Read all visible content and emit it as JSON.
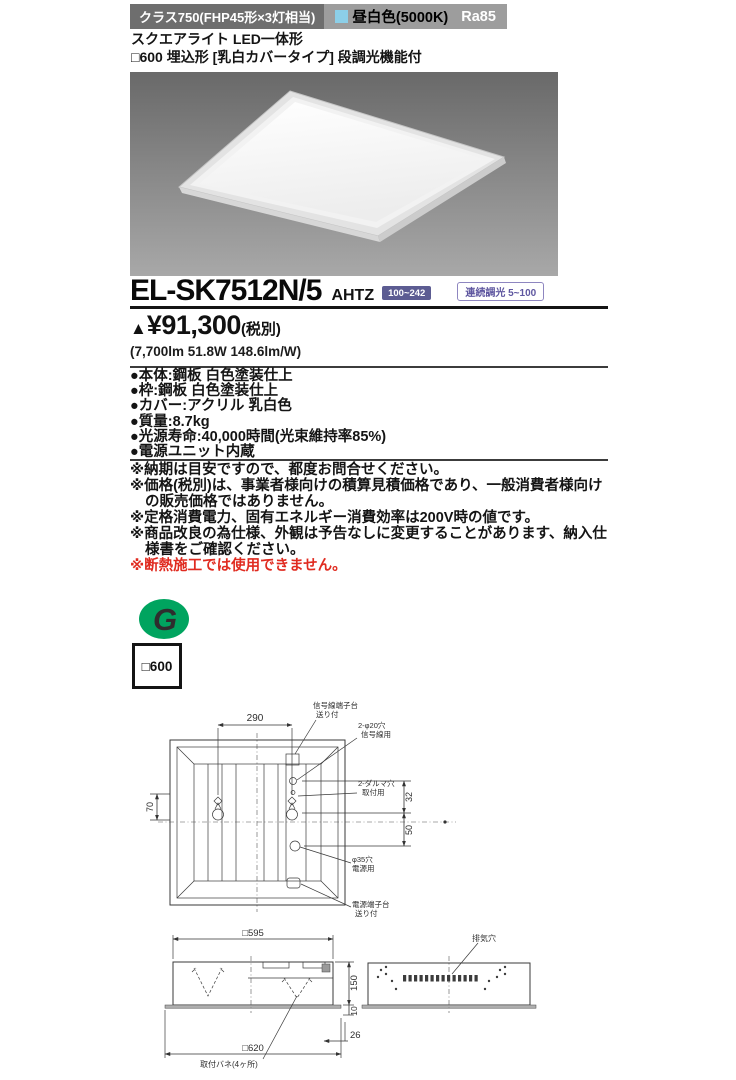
{
  "header": {
    "class_label": "クラス750(FHP45形×3灯相当)",
    "color_label": "昼白色(5000K)",
    "ra_label": "Ra85",
    "swatch_color": "#8ccfe8"
  },
  "subtitle": {
    "line1": "スクエアライト LED一体形",
    "line2": "□600 埋込形 [乳白カバータイプ] 段調光機能付"
  },
  "product": {
    "model": "EL-SK7512N/5",
    "model_suffix": "AHTZ",
    "badge_voltage": "100~242",
    "badge_dimming": "連続調光 5~100",
    "price_mark": "▲",
    "price_value": "¥91,300",
    "price_tax": "(税別)",
    "performance": "(7,700lm 51.8W 148.6lm/W)"
  },
  "specs": [
    "●本体:鋼板 白色塗装仕上",
    "●枠:鋼板 白色塗装仕上",
    "●カバー:アクリル 乳白色",
    "●質量:8.7kg",
    "●光源寿命:40,000時間(光束維持率85%)",
    "●電源ユニット内蔵"
  ],
  "notes": [
    "※納期は目安ですので、都度お問合せください。",
    "※価格(税別)は、事業者様向けの積算見積価格であり、一般消費者様向けの販売価格ではありません。",
    "※定格消費電力、固有エネルギー消費効率は200V時の値です。",
    "※商品改良の為仕様、外観は予告なしに変更することがあります、納入仕様書をご確認ください。"
  ],
  "warning": "※断熱施工では使用できません。",
  "logo": {
    "letter": "G",
    "color": "#00a45f"
  },
  "size_badge": "□600",
  "colors": {
    "header_dark": "#6e6e6e",
    "header_light": "#9d9d9d",
    "swatch_blue": "#8ccfe8",
    "badge_purple": "#5c5c92",
    "warning_red": "#e02b20",
    "logo_green": "#00a45f"
  },
  "drawing_top": {
    "dim_width": "290",
    "dim_left": "70",
    "dim_upper": "32",
    "dim_lower": "50",
    "signal_terminal_l1": "信号線端子台",
    "signal_terminal_l2": "送り付",
    "signal_holes_l1": "2-φ20穴",
    "signal_holes_l2": "信号線用",
    "daruma_l1": "2-ダルマ穴",
    "daruma_l2": "取付用",
    "power_hole_l1": "φ35穴",
    "power_hole_l2": "電源用",
    "power_terminal_l1": "電源端子台",
    "power_terminal_l2": "送り付"
  },
  "drawing_bottom": {
    "dim_top": "□595",
    "dim_height": "150",
    "dim_lip": "10",
    "dim_depth": "26",
    "dim_bottom": "□620",
    "spring_label": "取付バネ(4ヶ所)",
    "vent_label": "排気穴"
  }
}
